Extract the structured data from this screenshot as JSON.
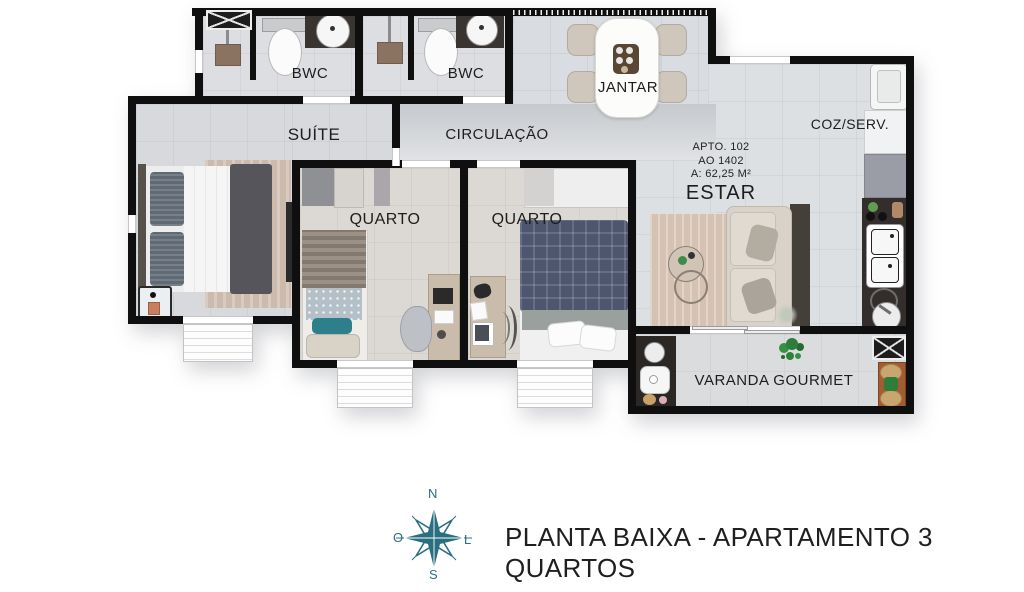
{
  "plan": {
    "rooms": {
      "bwc1": {
        "label": "BWC"
      },
      "bwc2": {
        "label": "BWC"
      },
      "jantar": {
        "label": "JANTAR"
      },
      "coz_serv": {
        "label": "COZ/SERV."
      },
      "suite": {
        "label": "SUÍTE"
      },
      "circulacao": {
        "label": "CIRCULAÇÃO"
      },
      "quarto1": {
        "label": "QUARTO"
      },
      "quarto2": {
        "label": "QUARTO"
      },
      "estar": {
        "label": "ESTAR"
      },
      "varanda": {
        "label": "VARANDA GOURMET"
      }
    },
    "apartment_info": {
      "apto": "APTO.  102",
      "unit": "AO 1402",
      "area": "A: 62,25 M²"
    }
  },
  "compass": {
    "north": "N",
    "south": "S",
    "west": "O",
    "east": "L",
    "color": "#2a6f80"
  },
  "caption": "PLANTA BAIXA  - APARTAMENTO 3 QUARTOS",
  "colors": {
    "wall": "#0f0f0f",
    "floor": "#dcdfe2",
    "accent_teal": "#2a6f80",
    "wood": "#a35c32"
  }
}
